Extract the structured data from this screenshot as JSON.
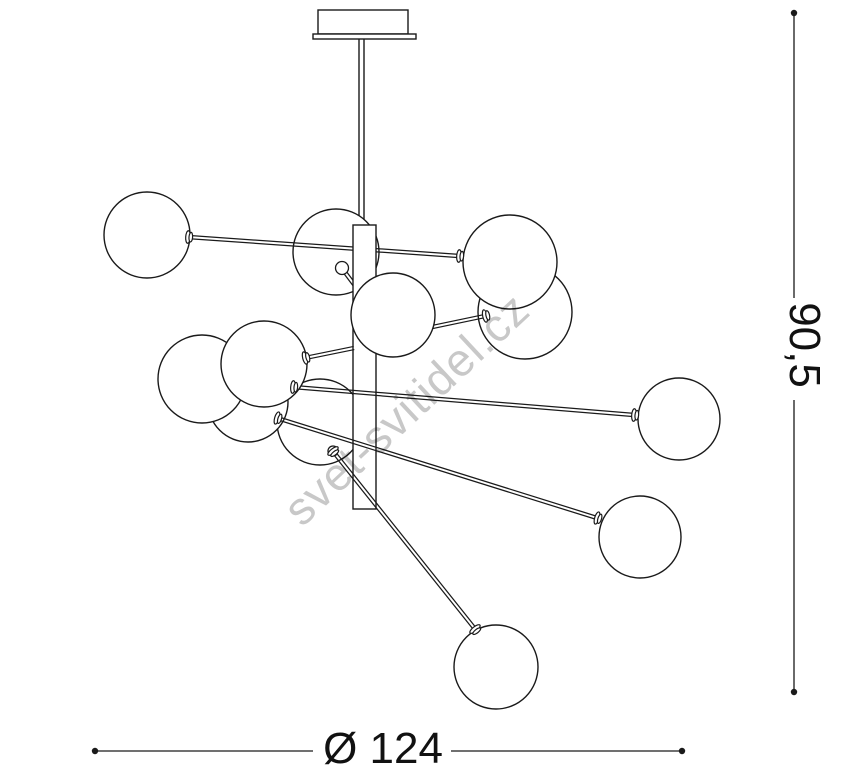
{
  "diagram": {
    "type": "technical-drawing",
    "subject": "pendant chandelier with twelve glass globes - dimensional drawing",
    "line_color": "#1a1a1a",
    "fill_color": "#ffffff",
    "canvas": {
      "width": 868,
      "height": 782
    },
    "watermark": {
      "text": "svet-svitidel.cz",
      "color": "#c8c8c8",
      "x": 302,
      "y": 528,
      "angle": -43,
      "font_size": 46
    },
    "dimensions": {
      "width": {
        "label": "Ø 124",
        "line_y": 751,
        "x_start": 95,
        "x_end": 682,
        "gap_start": 313,
        "gap_end": 451,
        "label_x": 383,
        "label_y": 763,
        "font_size": 44
      },
      "height": {
        "label": "90,5",
        "line_x": 794,
        "y_start": 13,
        "y_end": 692,
        "gap_start": 298,
        "gap_end": 400,
        "label_cx": 790,
        "label_cy": 345,
        "font_size": 44
      }
    },
    "fixture": {
      "canopy": {
        "x": 318,
        "y": 10,
        "w": 90,
        "h": 24
      },
      "canopy_flange": {
        "x": 313,
        "y": 34,
        "w": 103,
        "h": 5
      },
      "stem": {
        "x": 359,
        "y": 36,
        "w": 5,
        "h": 192
      },
      "bar": {
        "x": 353,
        "y": 225,
        "w": 23,
        "h": 284
      },
      "spheres_back": [
        {
          "cx": 320,
          "cy": 422,
          "r": 43
        },
        {
          "cx": 248,
          "cy": 402,
          "r": 40
        },
        {
          "cx": 202,
          "cy": 379,
          "r": 44
        },
        {
          "cx": 336,
          "cy": 252,
          "r": 43
        },
        {
          "cx": 525,
          "cy": 312,
          "r": 47
        }
      ],
      "arms_behind_bar": [
        {
          "x1": 188,
          "y1": 237,
          "x2": 459,
          "y2": 256
        },
        {
          "x1": 344,
          "y1": 271,
          "x2": 356,
          "y2": 287
        }
      ],
      "arms_front": [
        {
          "x1": 305,
          "y1": 358,
          "x2": 354,
          "y2": 348
        },
        {
          "x1": 375,
          "y1": 339,
          "x2": 485,
          "y2": 316
        },
        {
          "x1": 293,
          "y1": 387,
          "x2": 634,
          "y2": 415
        },
        {
          "x1": 277,
          "y1": 418,
          "x2": 597,
          "y2": 518
        },
        {
          "x1": 336,
          "y1": 455,
          "x2": 475,
          "y2": 629
        }
      ],
      "knobs": [
        {
          "cx": 342,
          "cy": 268,
          "r": 6.5
        },
        {
          "cx": 333,
          "cy": 451,
          "r": 5
        }
      ],
      "spheres_front": [
        {
          "cx": 264,
          "cy": 364,
          "r": 43
        },
        {
          "cx": 510,
          "cy": 262,
          "r": 47
        },
        {
          "cx": 393,
          "cy": 315,
          "r": 42
        },
        {
          "cx": 147,
          "cy": 235,
          "r": 43
        },
        {
          "cx": 679,
          "cy": 419,
          "r": 41
        },
        {
          "cx": 640,
          "cy": 537,
          "r": 41
        },
        {
          "cx": 496,
          "cy": 667,
          "r": 42
        }
      ],
      "flanges": [
        {
          "cx": 188,
          "cy": 237,
          "angle": 4
        },
        {
          "cx": 459,
          "cy": 256,
          "angle": 4
        },
        {
          "cx": 485,
          "cy": 316,
          "angle": -12
        },
        {
          "cx": 305,
          "cy": 358,
          "angle": -14
        },
        {
          "cx": 293,
          "cy": 387,
          "angle": 5
        },
        {
          "cx": 634,
          "cy": 415,
          "angle": 5
        },
        {
          "cx": 277,
          "cy": 418,
          "angle": 17
        },
        {
          "cx": 597,
          "cy": 518,
          "angle": 17
        },
        {
          "cx": 475,
          "cy": 629,
          "angle": 52
        },
        {
          "cx": 333,
          "cy": 451,
          "angle": 52
        }
      ]
    }
  }
}
